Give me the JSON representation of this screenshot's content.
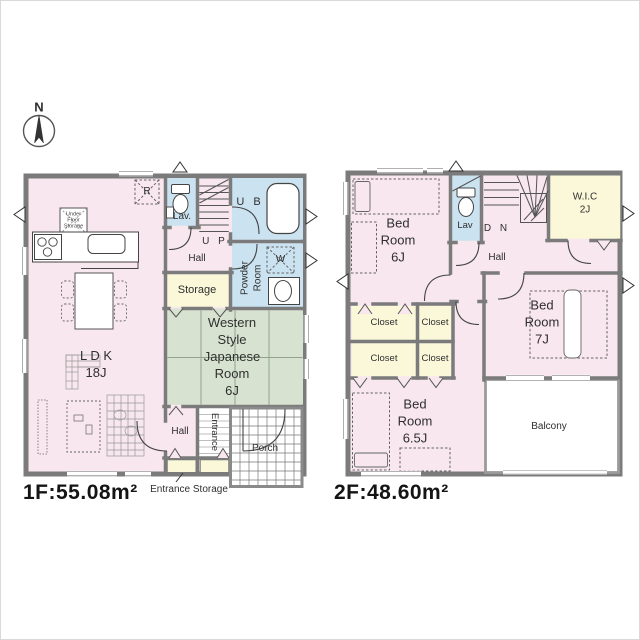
{
  "palette": {
    "wall": "#7b7b7b",
    "wall_light": "#9b9b9b",
    "pink": "#f8e7ee",
    "blue": "#cbe3f1",
    "yellow": "#fbf8d9",
    "green": "#d7e3d0",
    "white": "#ffffff"
  },
  "icons": {
    "compass": "compass-rose-north",
    "toilet": "toilet",
    "bathtub": "bathtub",
    "stove": "stove-three-burners",
    "kitchen_sink": "kitchen-sink",
    "vanity_sink": "vanity-basin",
    "washer_space": "washing-machine-space",
    "fridge_space": "refrigerator-space",
    "stairs_up": "staircase-up",
    "stairs_down": "staircase-down",
    "bed": "bed",
    "dining_table": "dining-table-with-chairs",
    "door_swing": "door-swing-arc",
    "window": "window-opening",
    "vent_arrow": "opening-direction-arrow"
  },
  "compass": {
    "north": "N"
  },
  "floor1": {
    "area_label": "1F:55.08m²",
    "ldk_label": "L D K\n18J",
    "lav_label": "Lav.",
    "up_label": "U P",
    "hall_upper_label": "Hall",
    "ub_label": "U B",
    "powder_label": "Powder\nRoom",
    "washer_label": "W",
    "fridge_label": "R",
    "under_floor_label": "Under\nFloor\nStorage",
    "storage_label": "Storage",
    "japanese_room_label": "Western\nStyle\nJapanese\nRoom\n6J",
    "hall_lower_label": "Hall",
    "entrance_label": "Entrance",
    "porch_label": "Porch",
    "entrance_storage_label": "Entrance Storage"
  },
  "floor2": {
    "area_label": "2F:48.60m²",
    "bedroom1_label": "Bed\nRoom\n6J",
    "lav_label": "Lav",
    "dn_label": "D N",
    "hall_label": "Hall",
    "wic_label": "W.I.C\n2J",
    "bedroom2_label": "Bed\nRoom\n7J",
    "closet_label": "Closet",
    "bedroom3_label": "Bed\nRoom\n6.5J",
    "balcony_label": "Balcony"
  }
}
